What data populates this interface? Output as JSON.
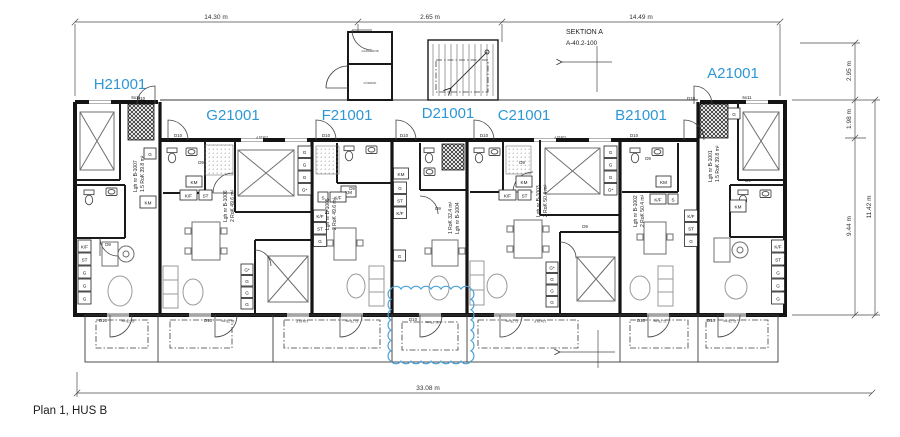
{
  "drawing_title": "Plan 1, HUS B",
  "colors": {
    "label_blue": "#2e97d5",
    "cloud_blue": "#4aa3d8",
    "wall": "#141414"
  },
  "section_marker": {
    "title": "SEKTION A",
    "ref": "A-40.2-100"
  },
  "dimensions": {
    "top_left": "14.30 m",
    "top_mid": "2.65 m",
    "top_right": "14.49 m",
    "right_upper": "2.95 m",
    "right_mid": "1.98 m",
    "right_lower": "9.44 m",
    "right_total": "11.42 m",
    "bottom_total": "33.08 m"
  },
  "units": [
    {
      "id": "H21001",
      "lgh": "Lgh nr B-1007",
      "typ": "1.5 RoK 39.8 m²"
    },
    {
      "id": "G21001",
      "lgh": "Lgh nr B-1006",
      "typ": "2 RoK 49.6 m²"
    },
    {
      "id": "F21001",
      "lgh": "Lgh nr B-1005",
      "typ": "2 RoK 49.6 m²"
    },
    {
      "id": "D21001",
      "lgh": "Lgh nr B-1004",
      "typ": "1 RoK 32.4 m²"
    },
    {
      "id": "C21001",
      "lgh": "Lgh nr B-1003",
      "typ": "2 RoK 50.4 m²"
    },
    {
      "id": "B21001",
      "lgh": "Lgh nr B-1002",
      "typ": "2 RoK 50.4 m²"
    },
    {
      "id": "A21001",
      "lgh": "Lgh nr B-1001",
      "typ": "1.5 RoK 39.8 m²"
    }
  ],
  "glyphs": {
    "wardrobe": "G",
    "wardrobe_star": "G*",
    "washer": "KM",
    "cleaning": "ST",
    "fridge_freezer": "K/F",
    "s": "S",
    "door_d9": "D9",
    "door_d10": "D10",
    "window_tag": "10x15 F",
    "window_tag_small": "6x11",
    "terrace_area": "11.75 m²",
    "storage": "FÖRRÅD",
    "wardrobe_room": "GARDEROB"
  }
}
